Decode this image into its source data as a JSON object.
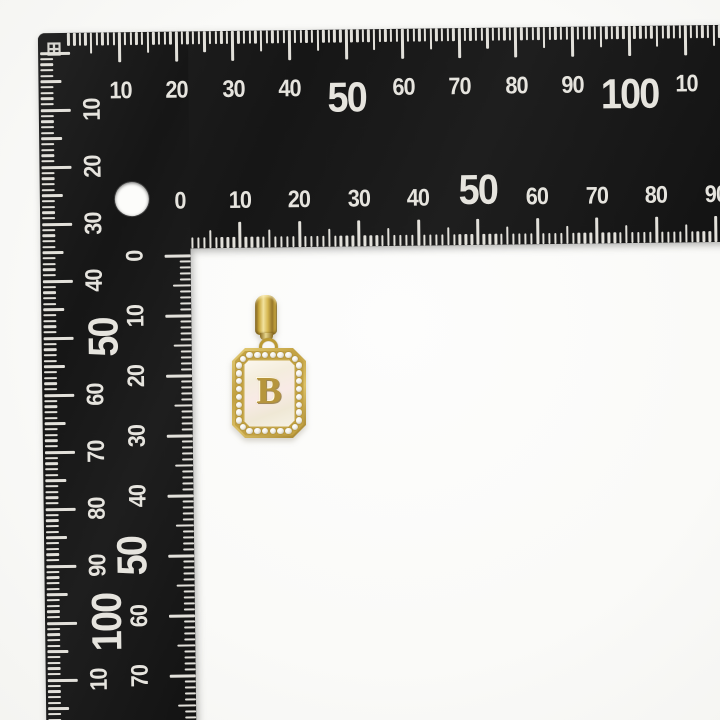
{
  "scene": {
    "type": "product-photo",
    "background_color": "#fafaf8"
  },
  "ruler": {
    "description": "black L-shaped square ruler, millimeter scales",
    "body_color": "#1a1a1a",
    "marking_color": "#e2e0da",
    "corner_mark": "⊞",
    "scales": {
      "top_outer": {
        "units": "mm",
        "labels": [
          {
            "unit": 10,
            "text": "10"
          },
          {
            "unit": 20,
            "text": "20"
          },
          {
            "unit": 30,
            "text": "30"
          },
          {
            "unit": 40,
            "text": "40"
          },
          {
            "unit": 50,
            "text": "50",
            "big": true
          },
          {
            "unit": 60,
            "text": "60"
          },
          {
            "unit": 70,
            "text": "70"
          },
          {
            "unit": 80,
            "text": "80"
          },
          {
            "unit": 90,
            "text": "90"
          },
          {
            "unit": 100,
            "text": "100",
            "big": true
          },
          {
            "unit": 110,
            "text": "10"
          }
        ]
      },
      "bottom_inner": {
        "units": "mm",
        "labels": [
          {
            "unit": 0,
            "text": "0"
          },
          {
            "unit": 10,
            "text": "10"
          },
          {
            "unit": 20,
            "text": "20"
          },
          {
            "unit": 30,
            "text": "30"
          },
          {
            "unit": 40,
            "text": "40"
          },
          {
            "unit": 50,
            "text": "50",
            "big": true
          },
          {
            "unit": 60,
            "text": "60"
          },
          {
            "unit": 70,
            "text": "70"
          },
          {
            "unit": 80,
            "text": "80"
          },
          {
            "unit": 90,
            "text": "90"
          }
        ]
      },
      "left_outer": {
        "units": "mm",
        "labels": [
          {
            "unit": 10,
            "text": "10"
          },
          {
            "unit": 20,
            "text": "20"
          },
          {
            "unit": 30,
            "text": "30"
          },
          {
            "unit": 40,
            "text": "40"
          },
          {
            "unit": 50,
            "text": "50",
            "big": true
          },
          {
            "unit": 60,
            "text": "60"
          },
          {
            "unit": 70,
            "text": "70"
          },
          {
            "unit": 80,
            "text": "80"
          },
          {
            "unit": 90,
            "text": "90"
          },
          {
            "unit": 100,
            "text": "100",
            "big": true
          },
          {
            "unit": 110,
            "text": "10"
          }
        ]
      },
      "right_inner": {
        "units": "mm",
        "labels": [
          {
            "unit": 0,
            "text": "0"
          },
          {
            "unit": 10,
            "text": "10"
          },
          {
            "unit": 20,
            "text": "20"
          },
          {
            "unit": 30,
            "text": "30"
          },
          {
            "unit": 40,
            "text": "40"
          },
          {
            "unit": 50,
            "text": "50",
            "big": true
          },
          {
            "unit": 60,
            "text": "60"
          },
          {
            "unit": 70,
            "text": "70"
          }
        ]
      }
    }
  },
  "pendant": {
    "letter": "B",
    "style": "gold rectangular tag pendant, white mother-of-pearl center, cubic-zirconia halo, ribbon bail",
    "colors": {
      "gold": "#c7a746",
      "gold_light": "#f2e29e",
      "gold_dark": "#8a6b20",
      "pearl": "#f6f0e2",
      "stone": "#ffffff"
    }
  }
}
